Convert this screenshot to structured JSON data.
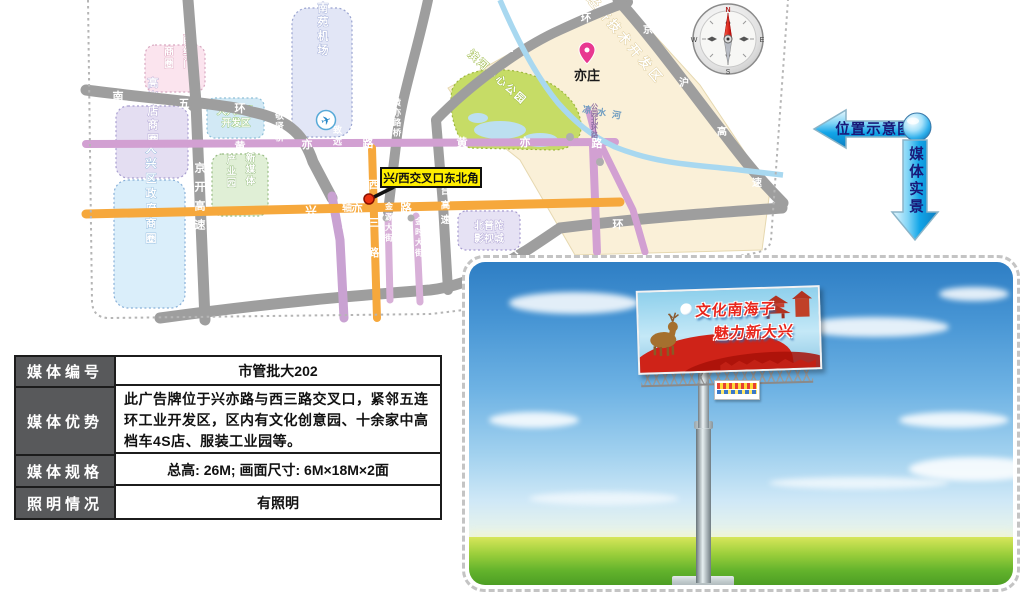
{
  "side_labels": {
    "location": "位置示意图",
    "media": "媒体实景"
  },
  "info_table": {
    "rows": [
      {
        "label": "媒体编号",
        "value": "市管批大202"
      },
      {
        "label": "媒体优势",
        "value": "此广告牌位于兴亦路与西三路交叉口，紧邻五连环工业开发区，区内有文化创意园、十余家中高档车4S店、服装工业园等。"
      },
      {
        "label": "媒体规格",
        "value": "总高: 26M; 画面尺寸: 6M×18M×2面"
      },
      {
        "label": "照明情况",
        "value": "有照明"
      }
    ]
  },
  "map": {
    "callout": "兴/西交叉口东北角",
    "river": "凉水河",
    "compass": {
      "n": "N",
      "e": "E",
      "s": "S",
      "w": "W"
    },
    "areas": {
      "xihongmen": {
        "col1": "西红门",
        "col2": "商圈"
      },
      "gaomidian": "高米店商圈",
      "daxing_gov": "大兴区政府商圈",
      "nanyuan": "南苑机场",
      "industry_dev": {
        "line1": "大兴工业",
        "line2": "开发区"
      },
      "media_park": {
        "col1": "新媒体",
        "col2": "产业园"
      },
      "beiputuo": {
        "line1": "北普陀",
        "line2": "影视城"
      },
      "bda": "北京经济技术开发区",
      "park": "滨河中心公园",
      "yizhuang": "亦庄"
    },
    "roads": {
      "s5ring_w": [
        "南",
        "五",
        "环"
      ],
      "s5ring_ne": [
        "南",
        "五",
        "环"
      ],
      "s5ring_e": "环",
      "jingkai": "京开高速",
      "huangyi_w": [
        "黄",
        "亦",
        "路"
      ],
      "huangyi_e": [
        "黄",
        "亦",
        "路"
      ],
      "huangyilu_bridge": "黄亦路桥",
      "jingxian_bridge": "敬贤桥",
      "zhiyuan_bridge": "致远西桥",
      "nanzhongzhou": "南中轴路",
      "xingyi": [
        "兴",
        "亦",
        "路"
      ],
      "xisan": [
        "西",
        "三",
        "路"
      ],
      "jinyuan": "金源大街",
      "jinshi": "金时大街",
      "jingtai": "京台高速",
      "jinghu": [
        "京",
        "沪",
        "高",
        "速"
      ],
      "da": "大",
      "gongyuanbeihuan": "公园北环路"
    }
  },
  "photo": {
    "billboard": {
      "line1": "文化南海子",
      "line2": "魅力新大兴"
    }
  }
}
